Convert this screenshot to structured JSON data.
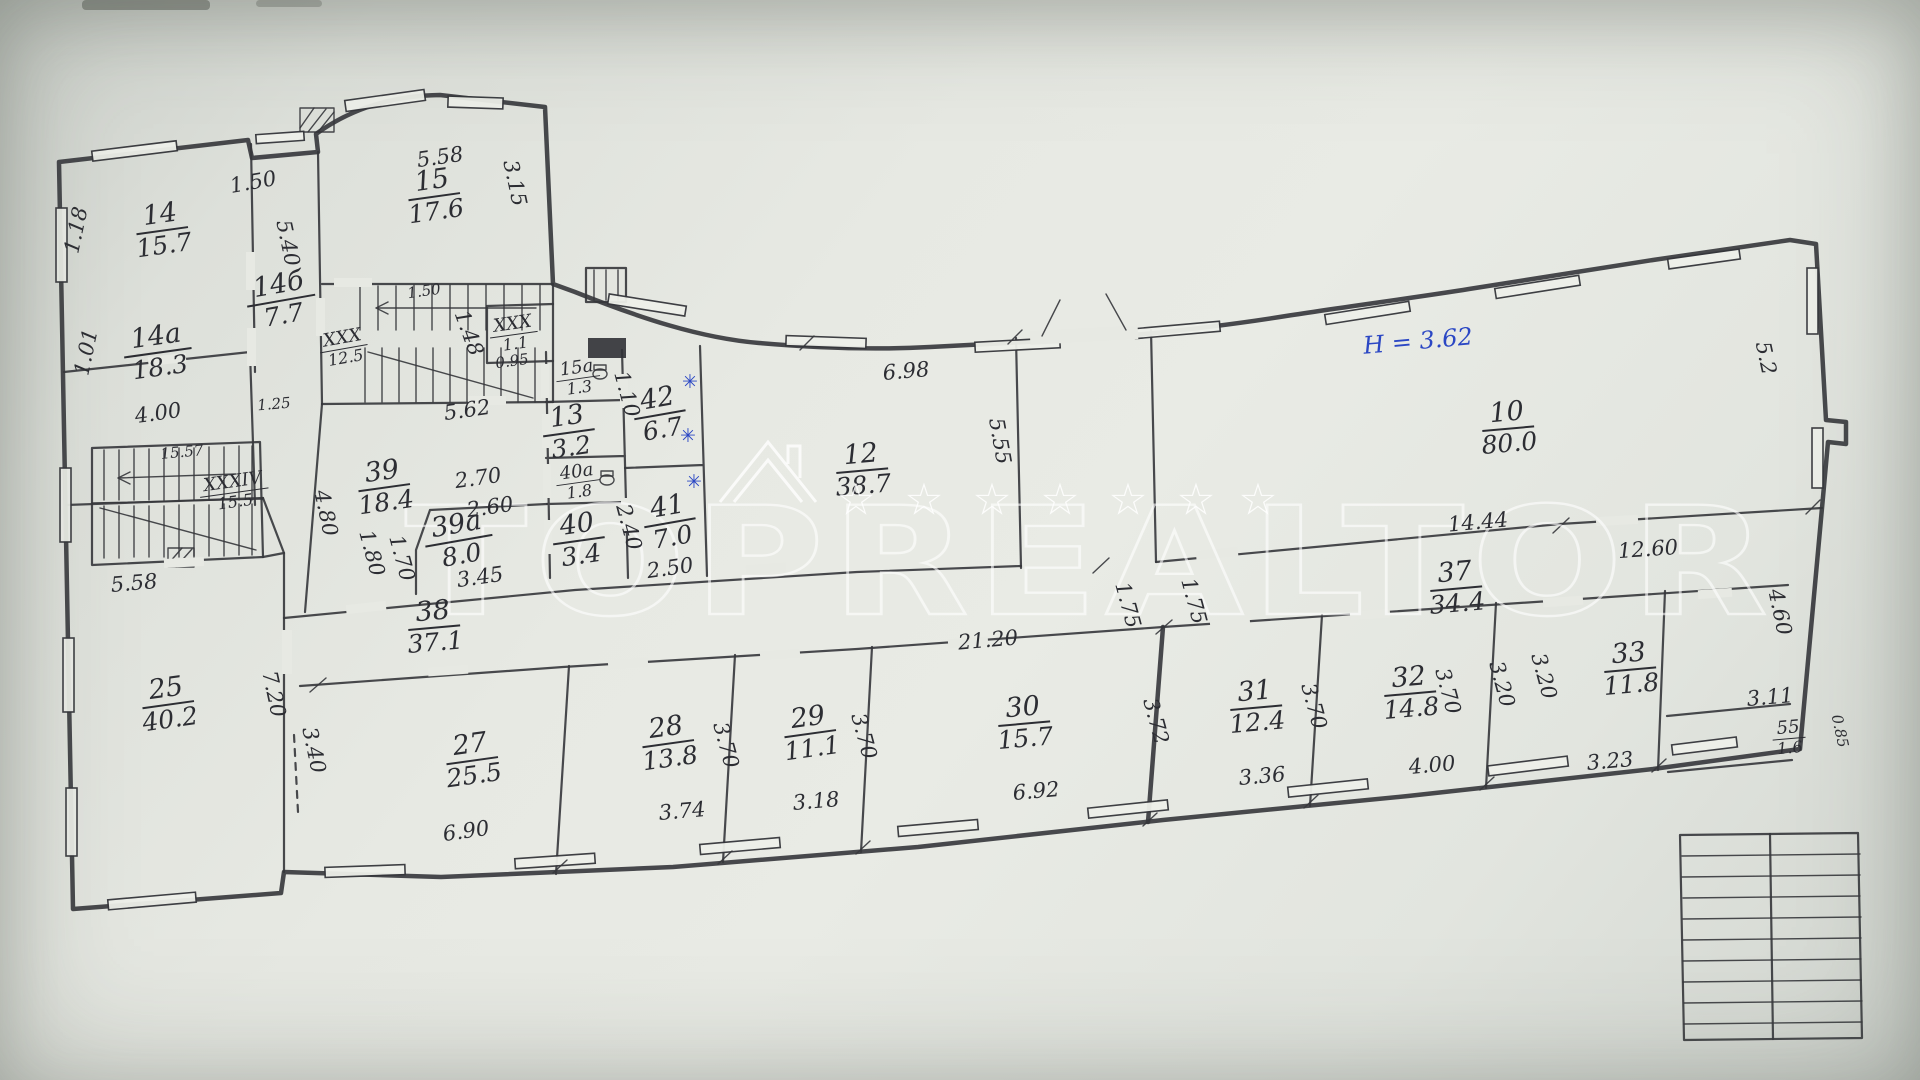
{
  "drawing_type": "floor-plan-scan",
  "height_note": {
    "t": "H = 3.62",
    "x": 1418,
    "y": 341,
    "r": -5,
    "blue": 1
  },
  "watermark": {
    "text": "TOPREALTOR",
    "star": "☆",
    "stars_x": [
      856,
      924,
      992,
      1060,
      1128,
      1196,
      1258
    ],
    "stars_y": 500
  },
  "rooms": [
    {
      "n": "14",
      "a": "15.7",
      "x": 162,
      "y": 230,
      "r": -8
    },
    {
      "n": "14а",
      "a": "18.3",
      "x": 158,
      "y": 352,
      "r": -8
    },
    {
      "n": "14б",
      "a": "7.7",
      "x": 281,
      "y": 300,
      "r": -10
    },
    {
      "n": "15",
      "a": "17.6",
      "x": 434,
      "y": 196,
      "r": -8
    },
    {
      "n": "XXX",
      "a": "12.5",
      "x": 344,
      "y": 348,
      "r": -10,
      "s": 1
    },
    {
      "n": "XXX",
      "a": "1.1",
      "x": 514,
      "y": 334,
      "r": -8,
      "s": 1
    },
    {
      "n": "15а",
      "a": "1.3",
      "x": 578,
      "y": 378,
      "r": -8,
      "s": 1
    },
    {
      "n": "13",
      "a": "3.2",
      "x": 569,
      "y": 432,
      "r": -8
    },
    {
      "n": "40а",
      "a": "1.8",
      "x": 578,
      "y": 482,
      "r": -8,
      "s": 1
    },
    {
      "n": "40",
      "a": "3.4",
      "x": 579,
      "y": 540,
      "r": -8
    },
    {
      "n": "41",
      "a": "7.0",
      "x": 670,
      "y": 522,
      "r": -10
    },
    {
      "n": "42",
      "a": "6.7",
      "x": 660,
      "y": 414,
      "r": -10
    },
    {
      "n": "39",
      "a": "18.4",
      "x": 384,
      "y": 487,
      "r": -8
    },
    {
      "n": "39а",
      "a": "8.0",
      "x": 459,
      "y": 540,
      "r": -10
    },
    {
      "n": "XXXIV",
      "a": "15.5",
      "x": 234,
      "y": 492,
      "r": -8,
      "s": 1
    },
    {
      "n": "12",
      "a": "38.7",
      "x": 862,
      "y": 470,
      "r": -5
    },
    {
      "n": "10",
      "a": "80.0",
      "x": 1508,
      "y": 428,
      "r": -5
    },
    {
      "n": "37",
      "a": "34.4",
      "x": 1456,
      "y": 588,
      "r": -5
    },
    {
      "n": "38",
      "a": "37.1",
      "x": 434,
      "y": 627,
      "r": -5
    },
    {
      "n": "25",
      "a": "40.2",
      "x": 168,
      "y": 704,
      "r": -8
    },
    {
      "n": "27",
      "a": "25.5",
      "x": 472,
      "y": 760,
      "r": -8
    },
    {
      "n": "28",
      "a": "13.8",
      "x": 668,
      "y": 743,
      "r": -8
    },
    {
      "n": "29",
      "a": "11.1",
      "x": 810,
      "y": 733,
      "r": -8
    },
    {
      "n": "30",
      "a": "15.7",
      "x": 1024,
      "y": 723,
      "r": -5
    },
    {
      "n": "31",
      "a": "12.4",
      "x": 1256,
      "y": 707,
      "r": -5
    },
    {
      "n": "32",
      "a": "14.8",
      "x": 1410,
      "y": 693,
      "r": -5
    },
    {
      "n": "33",
      "a": "11.8",
      "x": 1630,
      "y": 669,
      "r": -5
    },
    {
      "n": "55",
      "a": "1.6",
      "x": 1789,
      "y": 738,
      "r": -5,
      "s": 1
    }
  ],
  "dims": [
    {
      "t": "1.50",
      "x": 253,
      "y": 182,
      "r": -10
    },
    {
      "t": "5.58",
      "x": 440,
      "y": 157,
      "r": -8
    },
    {
      "t": "3.15",
      "x": 515,
      "y": 183,
      "r": 78
    },
    {
      "t": "1.18",
      "x": 76,
      "y": 230,
      "r": -78
    },
    {
      "t": "1.01",
      "x": 86,
      "y": 352,
      "r": -78
    },
    {
      "t": "4.00",
      "x": 158,
      "y": 413,
      "r": -8
    },
    {
      "t": "1.25",
      "x": 274,
      "y": 404,
      "r": -5,
      "small": 1
    },
    {
      "t": "5.40",
      "x": 288,
      "y": 243,
      "r": 78
    },
    {
      "t": "1.50",
      "x": 424,
      "y": 291,
      "r": -8,
      "small": 1
    },
    {
      "t": "1.48",
      "x": 469,
      "y": 333,
      "r": 70
    },
    {
      "t": "0.95",
      "x": 512,
      "y": 361,
      "r": -8,
      "small": 1
    },
    {
      "t": "15.57",
      "x": 182,
      "y": 452,
      "r": -5,
      "small": 1
    },
    {
      "t": "5.58",
      "x": 134,
      "y": 583,
      "r": -5
    },
    {
      "t": "7.20",
      "x": 274,
      "y": 694,
      "r": 78
    },
    {
      "t": "3.40",
      "x": 314,
      "y": 750,
      "r": 78
    },
    {
      "t": "5.62",
      "x": 467,
      "y": 410,
      "r": -8
    },
    {
      "t": "2.70",
      "x": 478,
      "y": 478,
      "r": -8
    },
    {
      "t": "2.60",
      "x": 490,
      "y": 507,
      "r": -8
    },
    {
      "t": "4.80",
      "x": 326,
      "y": 513,
      "r": 78
    },
    {
      "t": "1.80",
      "x": 372,
      "y": 553,
      "r": 75
    },
    {
      "t": "1.70",
      "x": 402,
      "y": 558,
      "r": 75
    },
    {
      "t": "3.45",
      "x": 480,
      "y": 577,
      "r": -8
    },
    {
      "t": "1.10",
      "x": 627,
      "y": 394,
      "r": 75
    },
    {
      "t": "2.40",
      "x": 629,
      "y": 527,
      "r": 75
    },
    {
      "t": "2.50",
      "x": 670,
      "y": 568,
      "r": -8
    },
    {
      "t": "6.98",
      "x": 906,
      "y": 371,
      "r": -5
    },
    {
      "t": "5.55",
      "x": 1000,
      "y": 441,
      "r": 80
    },
    {
      "t": "14.44",
      "x": 1478,
      "y": 522,
      "r": -5
    },
    {
      "t": "12.60",
      "x": 1648,
      "y": 549,
      "r": -4
    },
    {
      "t": "21.20",
      "x": 988,
      "y": 640,
      "r": -5
    },
    {
      "t": "1.75",
      "x": 1128,
      "y": 605,
      "r": 75
    },
    {
      "t": "1.75",
      "x": 1194,
      "y": 601,
      "r": 75
    },
    {
      "t": "5.2",
      "x": 1766,
      "y": 358,
      "r": 78
    },
    {
      "t": "4.60",
      "x": 1780,
      "y": 612,
      "r": 78
    },
    {
      "t": "3.11",
      "x": 1770,
      "y": 697,
      "r": -5
    },
    {
      "t": "0.85",
      "x": 1840,
      "y": 731,
      "r": 78,
      "small": 1
    },
    {
      "t": "3.36",
      "x": 1262,
      "y": 776,
      "r": -5
    },
    {
      "t": "4.00",
      "x": 1432,
      "y": 765,
      "r": -5
    },
    {
      "t": "3.23",
      "x": 1610,
      "y": 761,
      "r": -5
    },
    {
      "t": "3.74",
      "x": 682,
      "y": 811,
      "r": -5
    },
    {
      "t": "3.18",
      "x": 816,
      "y": 801,
      "r": -5
    },
    {
      "t": "6.92",
      "x": 1036,
      "y": 791,
      "r": -5
    },
    {
      "t": "6.90",
      "x": 466,
      "y": 831,
      "r": -8
    },
    {
      "t": "3.70",
      "x": 726,
      "y": 745,
      "r": 75
    },
    {
      "t": "3.70",
      "x": 864,
      "y": 736,
      "r": 75
    },
    {
      "t": "3.72",
      "x": 1156,
      "y": 721,
      "r": 75
    },
    {
      "t": "3.70",
      "x": 1314,
      "y": 706,
      "r": 75
    },
    {
      "t": "3.70",
      "x": 1448,
      "y": 691,
      "r": 75
    },
    {
      "t": "3.20",
      "x": 1502,
      "y": 684,
      "r": 75
    },
    {
      "t": "3.20",
      "x": 1544,
      "y": 676,
      "r": 75
    }
  ],
  "radiators": [
    {
      "x": 690,
      "y": 382
    },
    {
      "x": 688,
      "y": 436
    },
    {
      "x": 694,
      "y": 482
    }
  ]
}
